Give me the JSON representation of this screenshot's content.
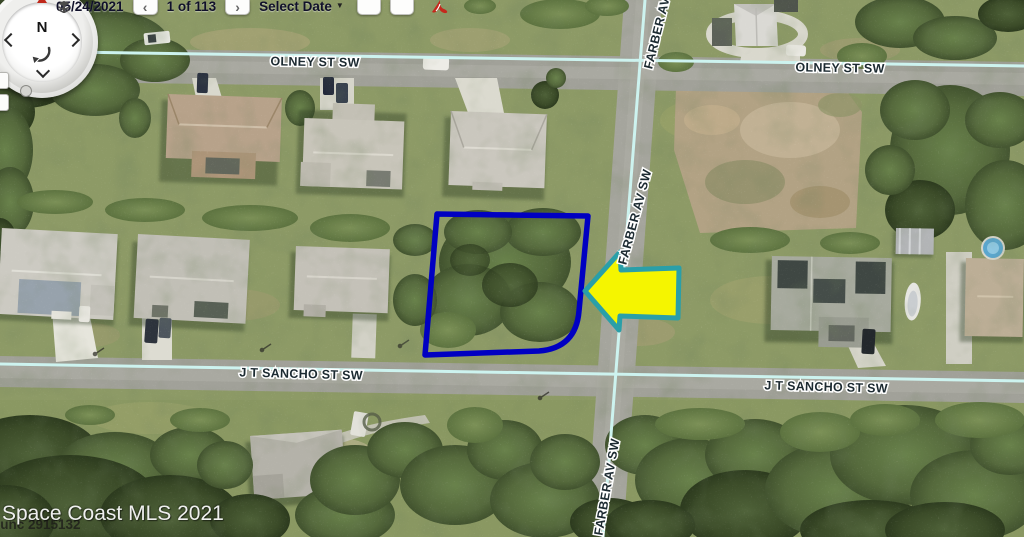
{
  "toolbar": {
    "date": "05/24/2021",
    "prev": "‹",
    "counter": "1 of 113",
    "next": "›",
    "select_date": "Select Date",
    "caret": "▼"
  },
  "compass": {
    "north": "N"
  },
  "streets": {
    "olney_left": "OLNEY ST SW",
    "olney_right": "OLNEY ST SW",
    "farber_top": "FARBER AV",
    "farber_mid": "FARBER AV SW",
    "farber_bottom": "FARBER AV SW",
    "sancho_left": "J T SANCHO ST SW",
    "sancho_right": "J T SANCHO ST SW"
  },
  "watermark": {
    "line1": "Space Coast MLS 2021",
    "line2": "ounc 2915132"
  },
  "colors": {
    "lot_outline": "#0000c2",
    "arrow_fill": "#f5f500",
    "arrow_stroke": "#2a9fa8",
    "street_line": "#cdf3ef"
  }
}
